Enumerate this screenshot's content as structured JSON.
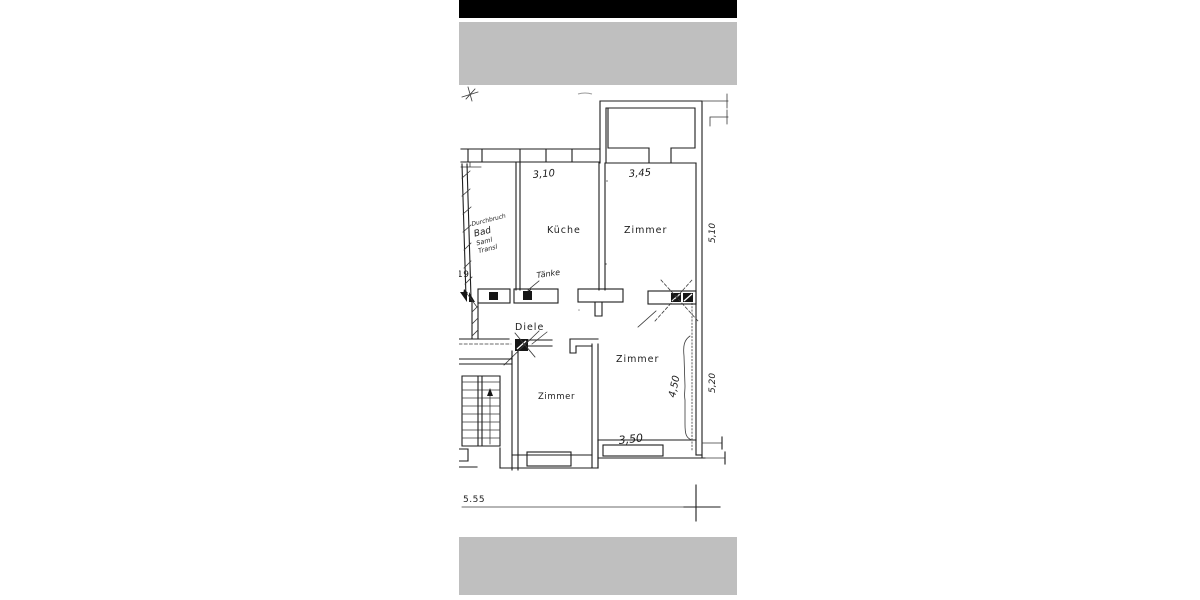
{
  "scan_strip": {
    "top_black_bar_color": "#000000",
    "gray_bar_color": "#bfbfbf",
    "paper_color": "#ffffff",
    "ink_color": "#1d1d1d"
  },
  "floorplan": {
    "rooms": {
      "kueche": "Küche",
      "zimmer_top": "Zimmer",
      "zimmer_right": "Zimmer",
      "zimmer_left": "Zimmer",
      "diele": "Diele"
    },
    "dimensions": {
      "top_left": "3,10",
      "top_right": "3,45",
      "right_upper": "5,10",
      "right_lower": "5,20",
      "inner_right": "4,50",
      "bottom_inner": "3,50",
      "bottom_total": "5.55"
    },
    "handwritten_notes": {
      "bad_line1": "Durchbruch",
      "bad_line2": "Bad",
      "bad_line3": "Saml",
      "bad_line4": "Transl",
      "sink_note": "Tänke",
      "edge_note": "19"
    }
  }
}
